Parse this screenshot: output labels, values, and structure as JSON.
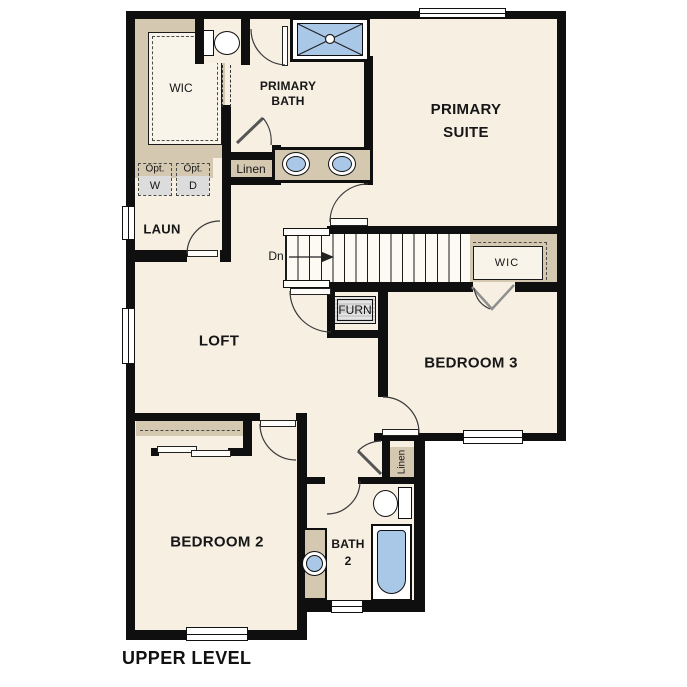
{
  "page_title": "UPPER LEVEL",
  "colors": {
    "floor": "#f6efe2",
    "cabinet_tan": "#d5c8b1",
    "fixture_blue": "#a9c8e8",
    "wall": "#0f0f0f",
    "appliance_gray": "#dcdcdc"
  },
  "rooms": {
    "primary_suite": {
      "line1": "PRIMARY",
      "line2": "SUITE"
    },
    "primary_bath": {
      "line1": "PRIMARY",
      "line2": "BATH"
    },
    "wic_primary": {
      "label": "WIC"
    },
    "laundry": {
      "label": "LAUN"
    },
    "loft": {
      "label": "LOFT"
    },
    "bedroom3": {
      "label": "BEDROOM 3"
    },
    "wic_bedroom3": {
      "label": "WIC"
    },
    "bedroom2": {
      "label": "BEDROOM 2"
    },
    "bath2": {
      "line1": "BATH",
      "line2": "2"
    }
  },
  "closets": {
    "linen_hall": "Linen",
    "linen_bath2": "Linen"
  },
  "stairs": {
    "direction_label": "Dn"
  },
  "equipment": {
    "furnace": "FURN",
    "washer": {
      "prefix": "Opt.",
      "letter": "W"
    },
    "dryer": {
      "prefix": "Opt.",
      "letter": "D"
    }
  }
}
